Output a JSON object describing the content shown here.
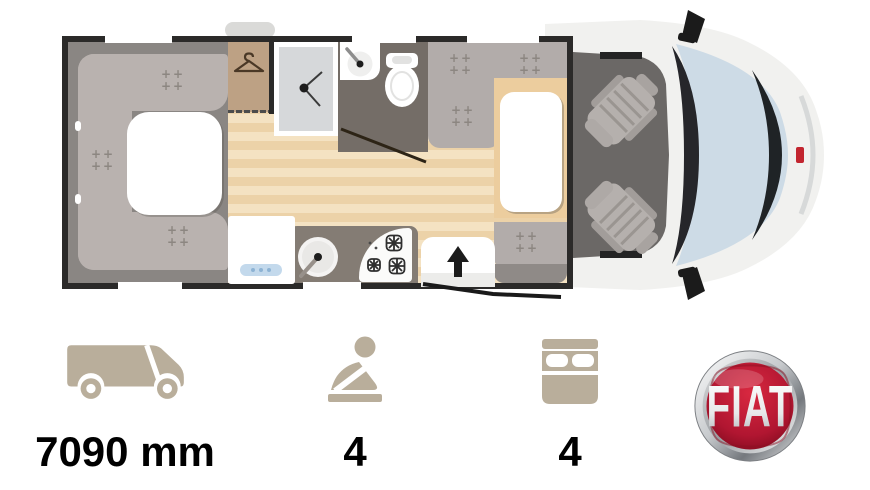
{
  "floorplan": {
    "type": "motorhome-top-view-floorplan",
    "features": [
      "u-shaped-rear-lounge",
      "lounge-table",
      "wardrobe",
      "shower-cubicle",
      "washroom-sink",
      "toilet",
      "kitchen-sink",
      "gas-hob",
      "fridge",
      "entrance-door",
      "dinette-seats",
      "dinette-table",
      "cab-swivel-seats",
      "windshield",
      "side-mirrors"
    ]
  },
  "specs": {
    "length": {
      "icon": "van-side-icon",
      "value": "7090 mm"
    },
    "travel_seats": {
      "icon": "seated-person-icon",
      "value": "4"
    },
    "berths": {
      "icon": "double-bed-icon",
      "value": "4"
    }
  },
  "brand": {
    "icon": "fiat-logo",
    "name": "FIAT"
  },
  "colors": {
    "accent_beige": "#b9ae9b",
    "label_text": "#000000",
    "fiat_red": "#a3122a",
    "wall_black": "#2b2a29",
    "floor_wood_light": "#f4e2c2",
    "floor_wood_dark": "#ecd2a8",
    "seat_gray": "#b9b2af",
    "module_floor_gray": "#8a8683",
    "bathroom_floor": "#746d67",
    "kitchen_counter": "#847c74",
    "wardrobe_tan": "#bda184",
    "windshield_blue": "#cddbe6",
    "cab_floor": "#6b6866",
    "background": "#ffffff"
  }
}
